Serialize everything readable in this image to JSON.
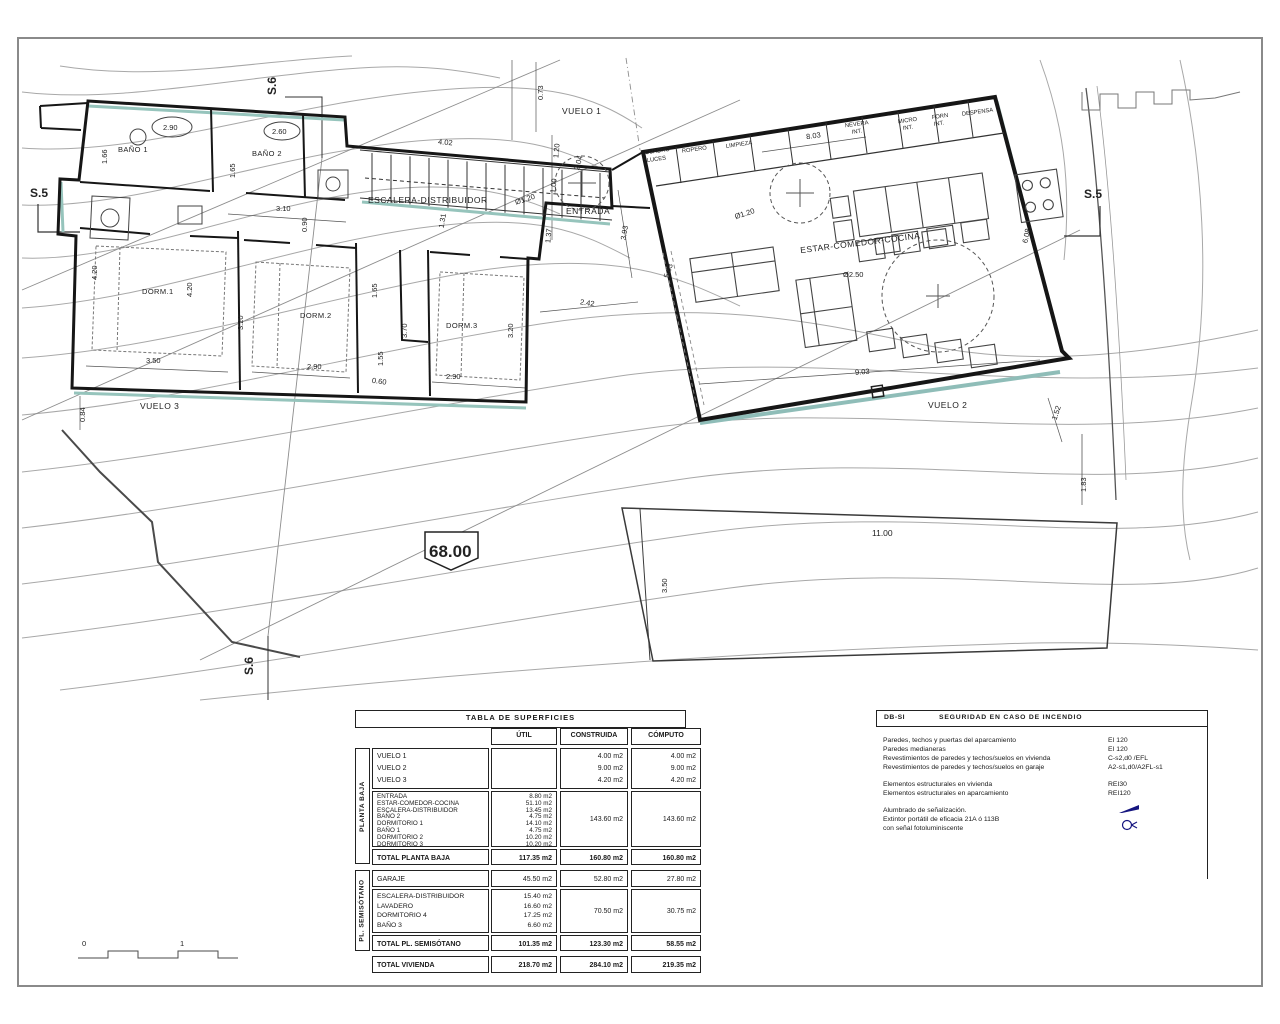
{
  "plan": {
    "labels": [
      "S.5",
      "S.5",
      "S.6",
      "S.6",
      "VUELO 1",
      "VUELO 2",
      "VUELO 3",
      "ENTRADA",
      "ESCALERA-DISTRIBUIDOR",
      "ESTAR-COMEDOR-COCINA",
      "BAÑO 1",
      "BAÑO 2",
      "DORM.1",
      "DORM.2",
      "DORM.3",
      "68.00",
      "2.90",
      "2.60",
      "1.66",
      "1.65",
      "3.10",
      "0.90",
      "4.20",
      "4.20",
      "3.50",
      "3.20",
      "2.90",
      "1.65",
      "3.70",
      "1.55",
      "0.60",
      "3.20",
      "2.90",
      "0.84",
      "0.73",
      "4.02",
      "1.31",
      "1.37",
      "1.00",
      "1.20",
      "Ø1.20",
      "2.04",
      "3.93",
      "5.83",
      "2.42",
      "CUADRO",
      "LUCES",
      "ROPERO",
      "LIMPIEZA",
      "8.03",
      "NEVERA",
      "INT.",
      "MICRO",
      "INT.",
      "FORN",
      "INT.",
      "DESPENSA",
      "Ø1.20",
      "Ø2.50",
      "6.08",
      "9.03",
      "1.52",
      "1.83",
      "11.00",
      "3.50",
      "0",
      "1"
    ]
  },
  "surf": {
    "title": "TABLA DE SUPERFICIES",
    "h_util": "ÚTIL",
    "h_cons": "CONSTRUIDA",
    "h_comp": "CÓMPUTO",
    "pb_label": "PLANTA BAJA",
    "ps_label": "PL. SEMISÓTANO",
    "vuelos": [
      {
        "n": "VUELO 1",
        "c": "4.00 m2",
        "k": "4.00 m2"
      },
      {
        "n": "VUELO 2",
        "c": "9.00 m2",
        "k": "9.00 m2"
      },
      {
        "n": "VUELO 3",
        "c": "4.20 m2",
        "k": "4.20 m2"
      }
    ],
    "pb_rooms": [
      {
        "n": "ENTRADA",
        "u": "8.80 m2"
      },
      {
        "n": "ESTAR-COMEDOR-COCINA",
        "u": "51.10 m2"
      },
      {
        "n": "ESCALERA-DISTRIBUIDOR",
        "u": "13.45 m2"
      },
      {
        "n": "BAÑO 2",
        "u": "4.75 m2"
      },
      {
        "n": "DORMITORIO 1",
        "u": "14.10 m2"
      },
      {
        "n": "BAÑO 1",
        "u": "4.75 m2"
      },
      {
        "n": "DORMITORIO 2",
        "u": "10.20 m2"
      },
      {
        "n": "DORMITORIO 3",
        "u": "10.20 m2"
      }
    ],
    "pb_rooms_c": "143.60 m2",
    "pb_rooms_k": "143.60 m2",
    "pb_total": {
      "n": "TOTAL PLANTA BAJA",
      "u": "117.35 m2",
      "c": "160.80 m2",
      "k": "160.80 m2"
    },
    "garaje": {
      "n": "GARAJE",
      "u": "45.50 m2",
      "c": "52.80 m2",
      "k": "27.80 m2"
    },
    "ps_rooms": [
      {
        "n": "ESCALERA-DISTRIBUIDOR",
        "u": "15.40 m2"
      },
      {
        "n": "LAVADERO",
        "u": "16.60 m2"
      },
      {
        "n": "DORMITORIO 4",
        "u": "17.25 m2"
      },
      {
        "n": "BAÑO 3",
        "u": "6.60 m2"
      }
    ],
    "ps_rooms_c": "70.50 m2",
    "ps_rooms_k": "30.75 m2",
    "ps_total": {
      "n": "TOTAL PL. SEMISÓTANO",
      "u": "101.35 m2",
      "c": "123.30 m2",
      "k": "58.55 m2"
    },
    "total": {
      "n": "TOTAL VIVIENDA",
      "u": "218.70 m2",
      "c": "284.10 m2",
      "k": "219.35 m2"
    }
  },
  "dbsi": {
    "code": "DB-SI",
    "title": "SEGURIDAD EN CASO DE INCENDIO",
    "rows": [
      {
        "l": "Paredes, techos y puertas del aparcamiento",
        "v": "EI 120"
      },
      {
        "l": "Paredes medianeras",
        "v": "EI 120"
      },
      {
        "l": "Revestimientos de paredes y techos/suelos en vivienda",
        "v": "C-s2,d0 /EFL"
      },
      {
        "l": "Revestimientos de paredes y techos/suelos en garaje",
        "v": "A2-s1,d0/A2FL-s1"
      },
      {
        "l": "Elementos estructurales en vivienda",
        "v": "REI30"
      },
      {
        "l": "Elementos estructurales en aparcamiento",
        "v": "REI120"
      },
      {
        "l": "Alumbrado de señalización.",
        "v": ""
      },
      {
        "l": "Extintor portátil de eficacia 21A ó 113B",
        "v": ""
      },
      {
        "l": "con señal fotoluminiscente",
        "v": ""
      }
    ],
    "colors": {
      "icon_blue": "#15157f"
    }
  }
}
